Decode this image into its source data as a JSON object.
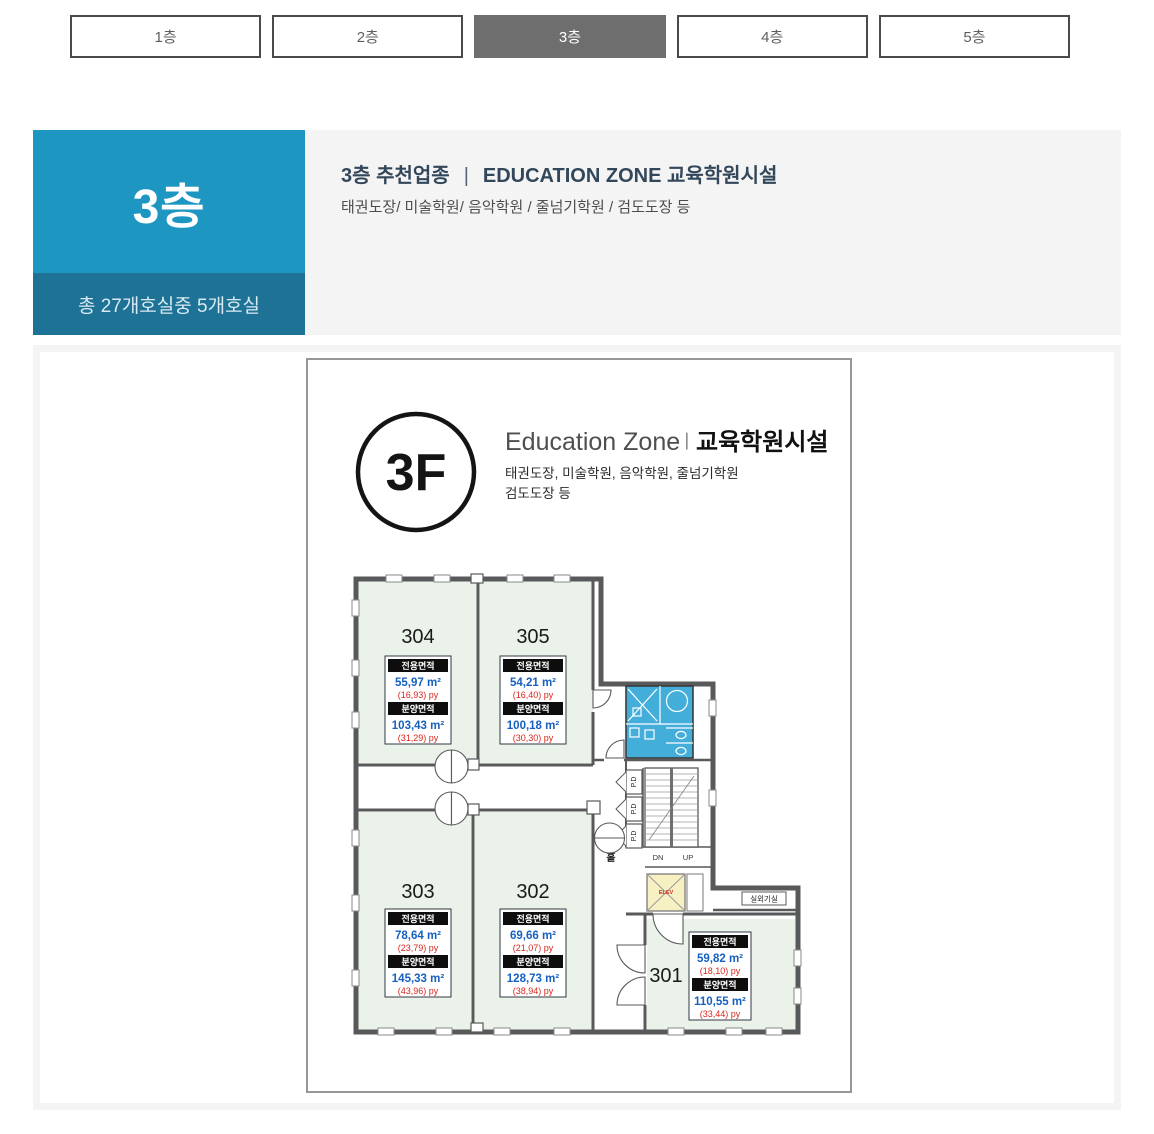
{
  "tabs": {
    "active_index": 2,
    "items": [
      {
        "label": "1층"
      },
      {
        "label": "2층"
      },
      {
        "label": "3층"
      },
      {
        "label": "4층"
      },
      {
        "label": "5층"
      }
    ]
  },
  "header": {
    "floor_big": "3층",
    "floor_sub": "총 27개호실중 5개호실",
    "recommend_prefix": "3층 추천업종",
    "divider": "|",
    "recommend_zone": "EDUCATION ZONE 교육학원시설",
    "description": "태권도장/ 미술학원/ 음악학원 / 줄넘기학원 / 검도도장 등",
    "accent_color": "#1e96c2",
    "accent_dark_color": "#1d7295"
  },
  "plan": {
    "badge": "3F",
    "title_en": "Education Zone",
    "title_divider": "ㅣ",
    "title_ko": "교육학원시설",
    "subtitle_line1": "태권도장, 미술학원, 음악학원, 줄넘기학원",
    "subtitle_line2": "검도도장 등",
    "area_labels": {
      "exclusive": "전용면적",
      "supply": "분양면적"
    },
    "labels": {
      "hall": "홀",
      "down": "DN",
      "up": "UP",
      "pd": "P.D",
      "elevator": "ELEV",
      "outdoor_unit": "실외기실"
    },
    "colors": {
      "room_fill": "#eaf2e9",
      "bathroom": "#44aedb",
      "elevator": "#f6f0c3",
      "wall": "#58595b",
      "value_blue": "#1560c0",
      "value_red": "#d9261c"
    },
    "rooms": [
      {
        "number": "301",
        "exclusive_m2": "59,82 m²",
        "exclusive_py": "(18,10) py",
        "supply_m2": "110,55 m²",
        "supply_py": "(33,44) py"
      },
      {
        "number": "302",
        "exclusive_m2": "69,66 m²",
        "exclusive_py": "(21,07) py",
        "supply_m2": "128,73 m²",
        "supply_py": "(38,94) py"
      },
      {
        "number": "303",
        "exclusive_m2": "78,64 m²",
        "exclusive_py": "(23,79) py",
        "supply_m2": "145,33 m²",
        "supply_py": "(43,96) py"
      },
      {
        "number": "304",
        "exclusive_m2": "55,97 m²",
        "exclusive_py": "(16,93) py",
        "supply_m2": "103,43 m²",
        "supply_py": "(31,29) py"
      },
      {
        "number": "305",
        "exclusive_m2": "54,21 m²",
        "exclusive_py": "(16,40) py",
        "supply_m2": "100,18 m²",
        "supply_py": "(30,30) py"
      }
    ]
  }
}
